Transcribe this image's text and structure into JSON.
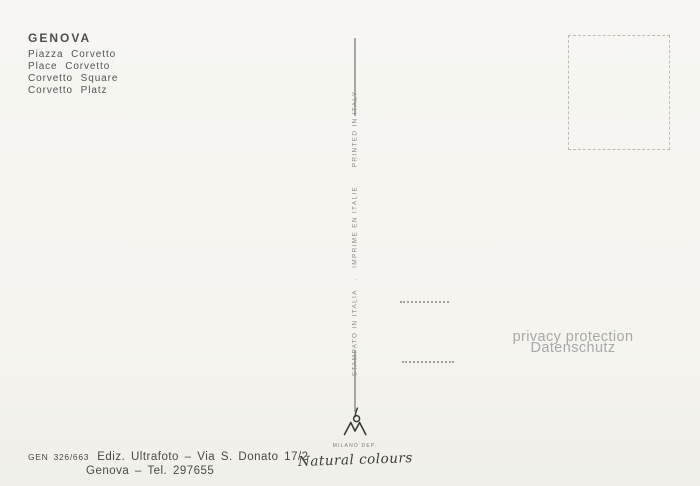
{
  "postcard": {
    "title": "GENOVA",
    "subtitle_lines": [
      "Piazza Corvetto",
      "Place Corvetto",
      "Corvetto Square",
      "Corvetto Platz"
    ],
    "divider_vertical_text": "STAMPATO IN ITALIA   .   IMPRIME EN ITALIE      PRINTED IN ITALY",
    "publisher_mark": {
      "monogram": "GM",
      "caption": "MILANO DEP.",
      "script": "Natural colours"
    },
    "imprint": {
      "code": "GEN 326/663",
      "line1": "Ediz. Ultrafoto  –  Via S. Donato 17/2",
      "line2": "Genova  –  Tel.  297655"
    },
    "watermark": {
      "line1": "privacy protection",
      "line2": "Datenschutz"
    },
    "colors": {
      "paper": "#f5f4ef",
      "ink": "#4e4e4e",
      "divider": "#a6a6a4",
      "watermark": "#a9a9a9",
      "stamp_box_border": "#bfbcb3"
    }
  }
}
